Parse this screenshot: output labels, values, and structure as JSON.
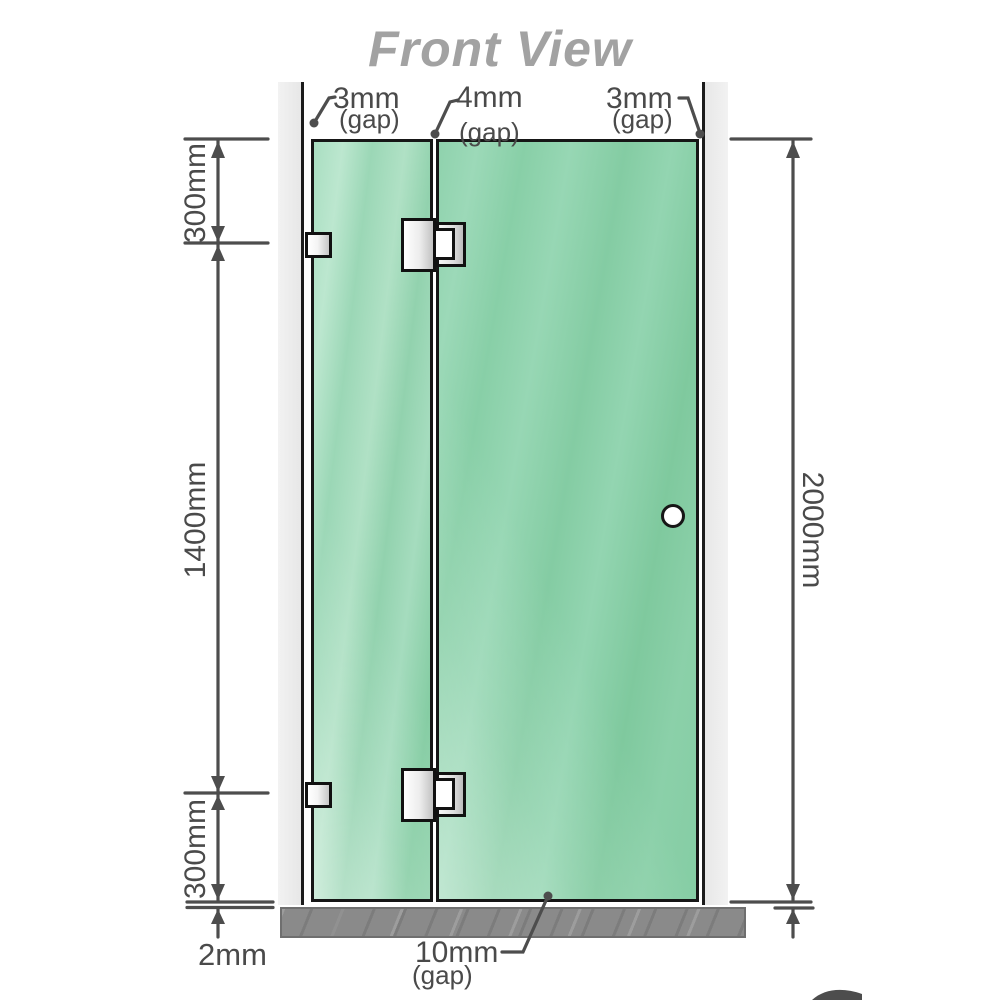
{
  "title": "Front View",
  "dimensions": {
    "left_top": "300mm",
    "left_middle": "1400mm",
    "left_bottom": "300mm",
    "right_full": "2000mm",
    "bottom_floor_gap": "2mm"
  },
  "gaps": {
    "top_left": {
      "value": "3mm",
      "suffix": "(gap)"
    },
    "top_middle": {
      "value": "4mm",
      "suffix": "(gap)"
    },
    "top_right": {
      "value": "3mm",
      "suffix": "(gap)"
    },
    "bottom_middle": {
      "value": "10mm",
      "suffix": "(gap)"
    }
  },
  "colors": {
    "glass_green": "#8bd0a9",
    "glass_green_light": "#bce7cf",
    "wall_gray": "#ececec",
    "floor_gray": "#8a8a8a",
    "outline_black": "#161616",
    "dimension_gray": "#4d4d4d",
    "title_gray": "#a2a2a2",
    "logo_red": "#7d1420"
  }
}
